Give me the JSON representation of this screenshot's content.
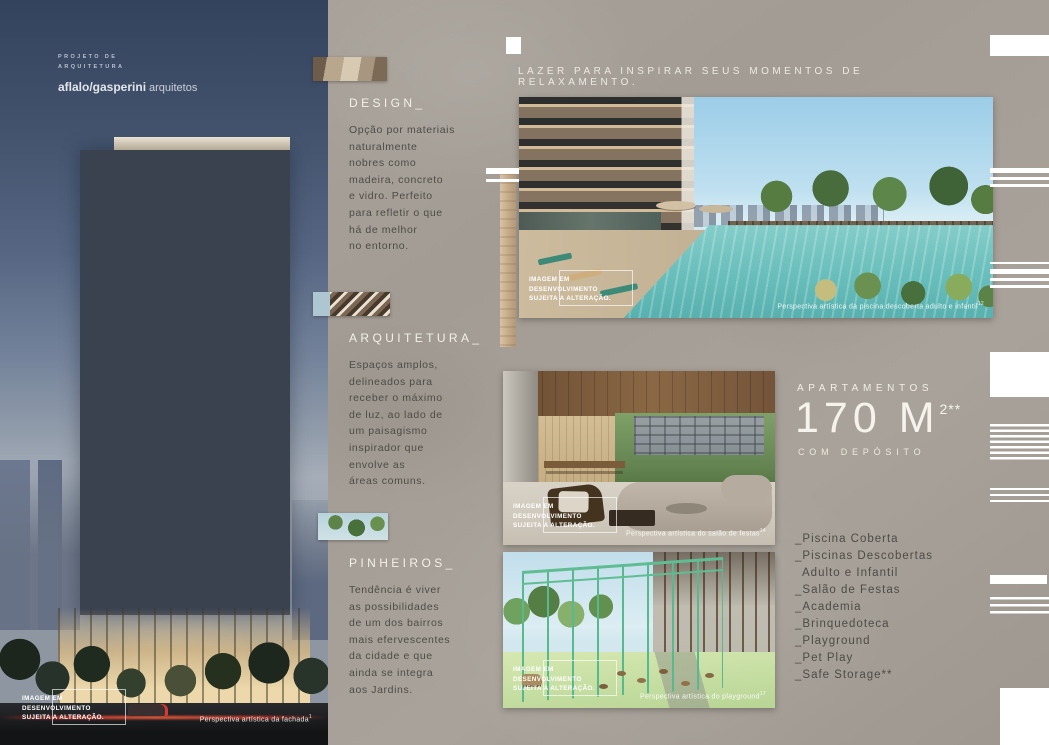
{
  "colors": {
    "concrete_background": "#a7a199",
    "dark_text": "#4e4b46",
    "light_text": "#f2efe8",
    "pool_turquoise": "#68bebb",
    "playground_green": "#58b98e",
    "dusk_sky": "#41516b"
  },
  "shared": {
    "disclaimer": "IMAGEM EM\nDESENVOLVIMENTO\nSUJEITA A ALTERAÇÃO."
  },
  "left_page": {
    "credit_line1": "PROJETO DE",
    "credit_line2": "ARQUITETURA",
    "brand_bold": "aflalo/gasperini",
    "brand_light": "arquitetos",
    "caption": "Perspectiva artística da fachada",
    "caption_sup": "1"
  },
  "middle_column": {
    "sections": [
      {
        "title": "DESIGN_",
        "body": "Opção por materiais\nnaturalmente\nnobres como\nmadeira, concreto\ne vidro. Perfeito\npara refletir o que\nhá de melhor\nno entorno."
      },
      {
        "title": "ARQUITETURA_",
        "body": "Espaços amplos,\ndelineados para\nreceber o máximo\nde luz, ao lado de\num paisagismo\ninspirador que\nenvolve as\náreas comuns."
      },
      {
        "title": "PINHEIROS_",
        "body": "Tendência é viver\nas possibilidades\nde um dos bairros\nmais efervescentes\nda cidade e que\nainda se integra\naos Jardins."
      }
    ]
  },
  "right_page": {
    "headline": "LAZER PARA INSPIRAR SEUS MOMENTOS DE RELAXAMENTO.",
    "pool_caption": "Perspectiva artística da piscina descoberta adulto e infantil",
    "pool_caption_sup": "12",
    "party_caption": "Perspectiva artística do salão de festas",
    "party_caption_sup": "14",
    "playground_caption": "Perspectiva artística do playground",
    "playground_caption_sup": "17",
    "apartments_label": "APARTAMENTOS",
    "area_value": "170 M",
    "area_sup": "2**",
    "area_sub": "COM DEPÓSITO",
    "amenities": [
      "_Piscina Coberta",
      "_Piscinas Descobertas",
      "Adulto e Infantil",
      "_Salão de Festas",
      "_Academia",
      "_Brinquedoteca",
      "_Playground",
      "_Pet Play",
      "_Safe Storage**"
    ]
  }
}
